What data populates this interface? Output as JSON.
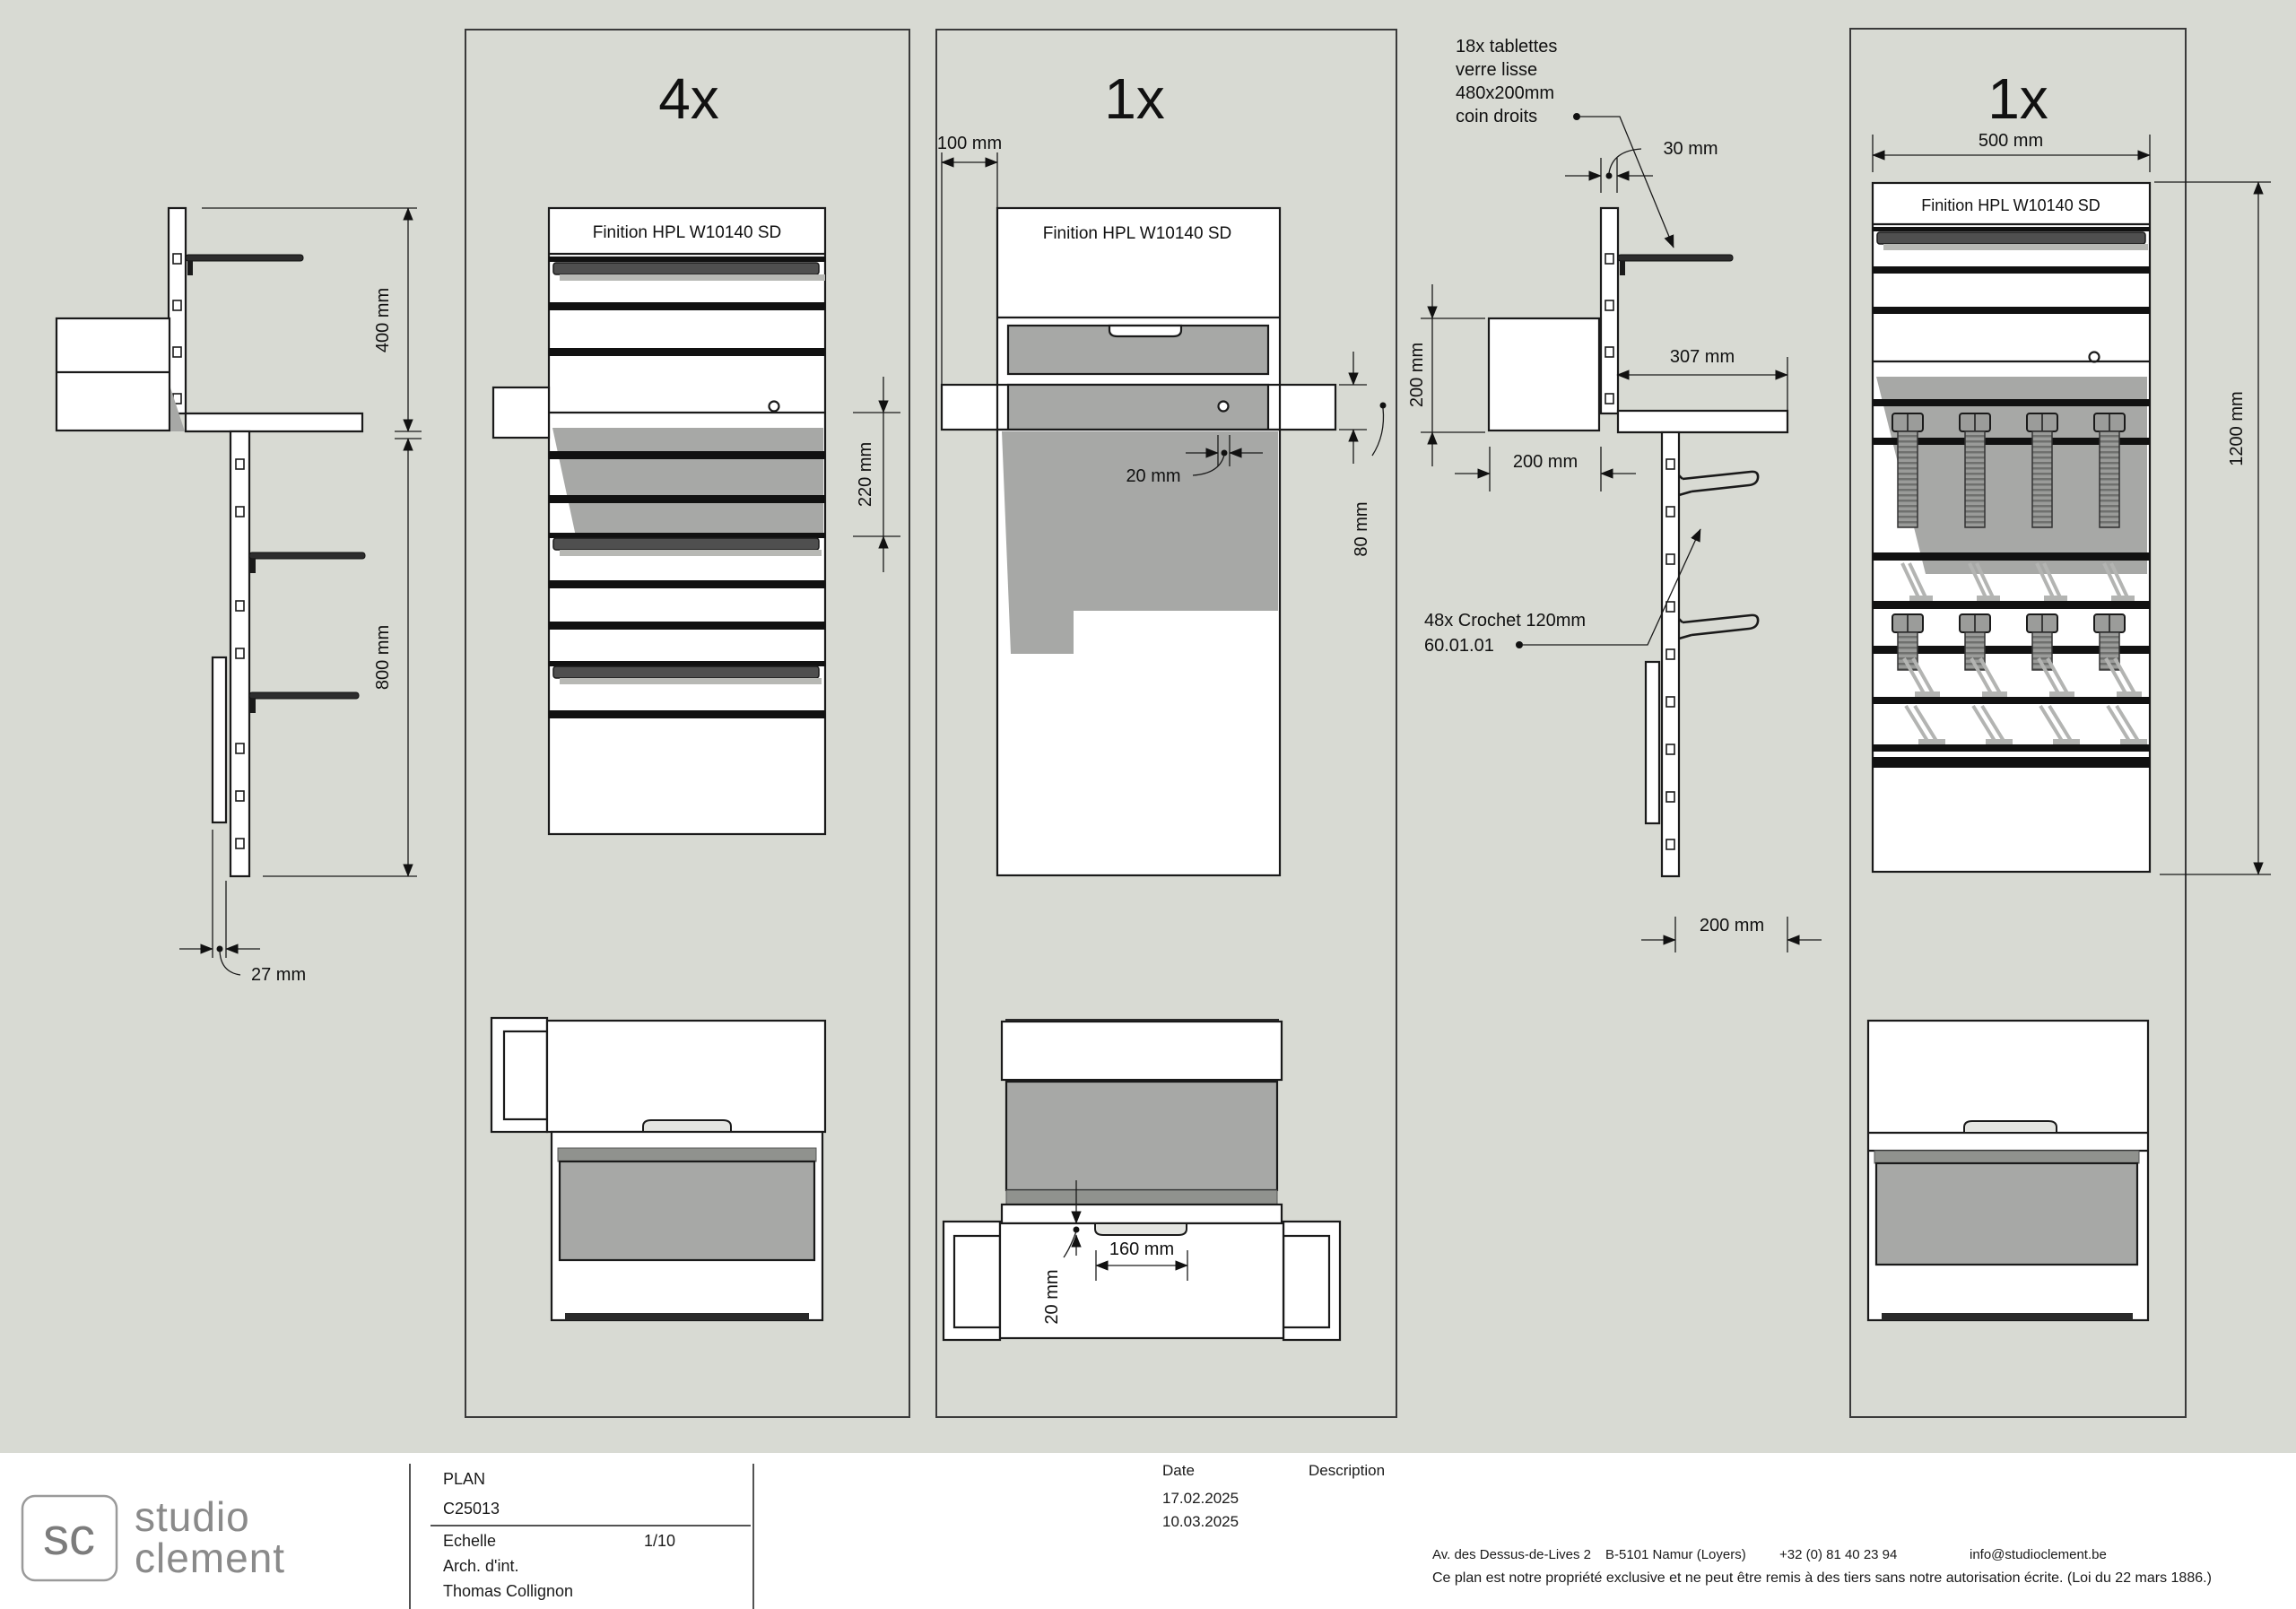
{
  "colors": {
    "background": "#d8dad3",
    "line": "#1a1a1a",
    "shadow_gray": "#a7a8a6",
    "glass_dark": "#4f4f4f",
    "texture_gray": "#90928e",
    "streak_gray": "#b3b4b2",
    "logo_gray": "#8a8a8a"
  },
  "drawing": {
    "finition_label": "Finition HPL W10140 SD",
    "side_left": {
      "dim_top": "400 mm",
      "dim_bottom": "800 mm",
      "dim_panel_thickness": "27 mm"
    },
    "panel_4x": {
      "count": "4x",
      "dim_glass_zone": "220 mm"
    },
    "panel_mid": {
      "count": "1x",
      "dim_side_offset": "100 mm",
      "dim_hole_offset": "20 mm",
      "dim_counter_height": "80 mm",
      "dim_handle_width": "160 mm",
      "dim_handle_depth": "20 mm"
    },
    "side_hooks": {
      "shelf_note_lines": [
        "18x tablettes",
        "verre lisse",
        "480x200mm",
        "coin droits"
      ],
      "dim_shelf_offset": "30 mm",
      "dim_height": "200 mm",
      "dim_depth": "307 mm",
      "dim_box_depth": "200 mm",
      "hook_note_lines": [
        "48x Crochet 120mm",
        "60.01.01"
      ],
      "dim_bottom_depth": "200 mm"
    },
    "panel_right": {
      "count": "1x",
      "dim_width": "500 mm",
      "dim_height": "1200 mm"
    }
  },
  "title_block": {
    "logo_mark": "sc",
    "logo_name_line1": "studio",
    "logo_name_line2": "clement",
    "doc_type": "PLAN",
    "project_code": "C25013",
    "scale_label": "Echelle",
    "scale_value": "1/10",
    "role": "Arch. d'int.",
    "author": "Thomas Collignon",
    "date_label": "Date",
    "description_label": "Description",
    "dates": [
      "17.02.2025",
      "10.03.2025"
    ],
    "address_line": "Av. des Dessus-de-Lives 2",
    "address_city": "B-5101 Namur (Loyers)",
    "phone": "+32 (0) 81 40 23 94",
    "email": "info@studioclement.be",
    "legal": "Ce plan est notre propriété exclusive et ne peut être remis à des tiers sans notre autorisation écrite. (Loi du 22 mars 1886.)"
  }
}
